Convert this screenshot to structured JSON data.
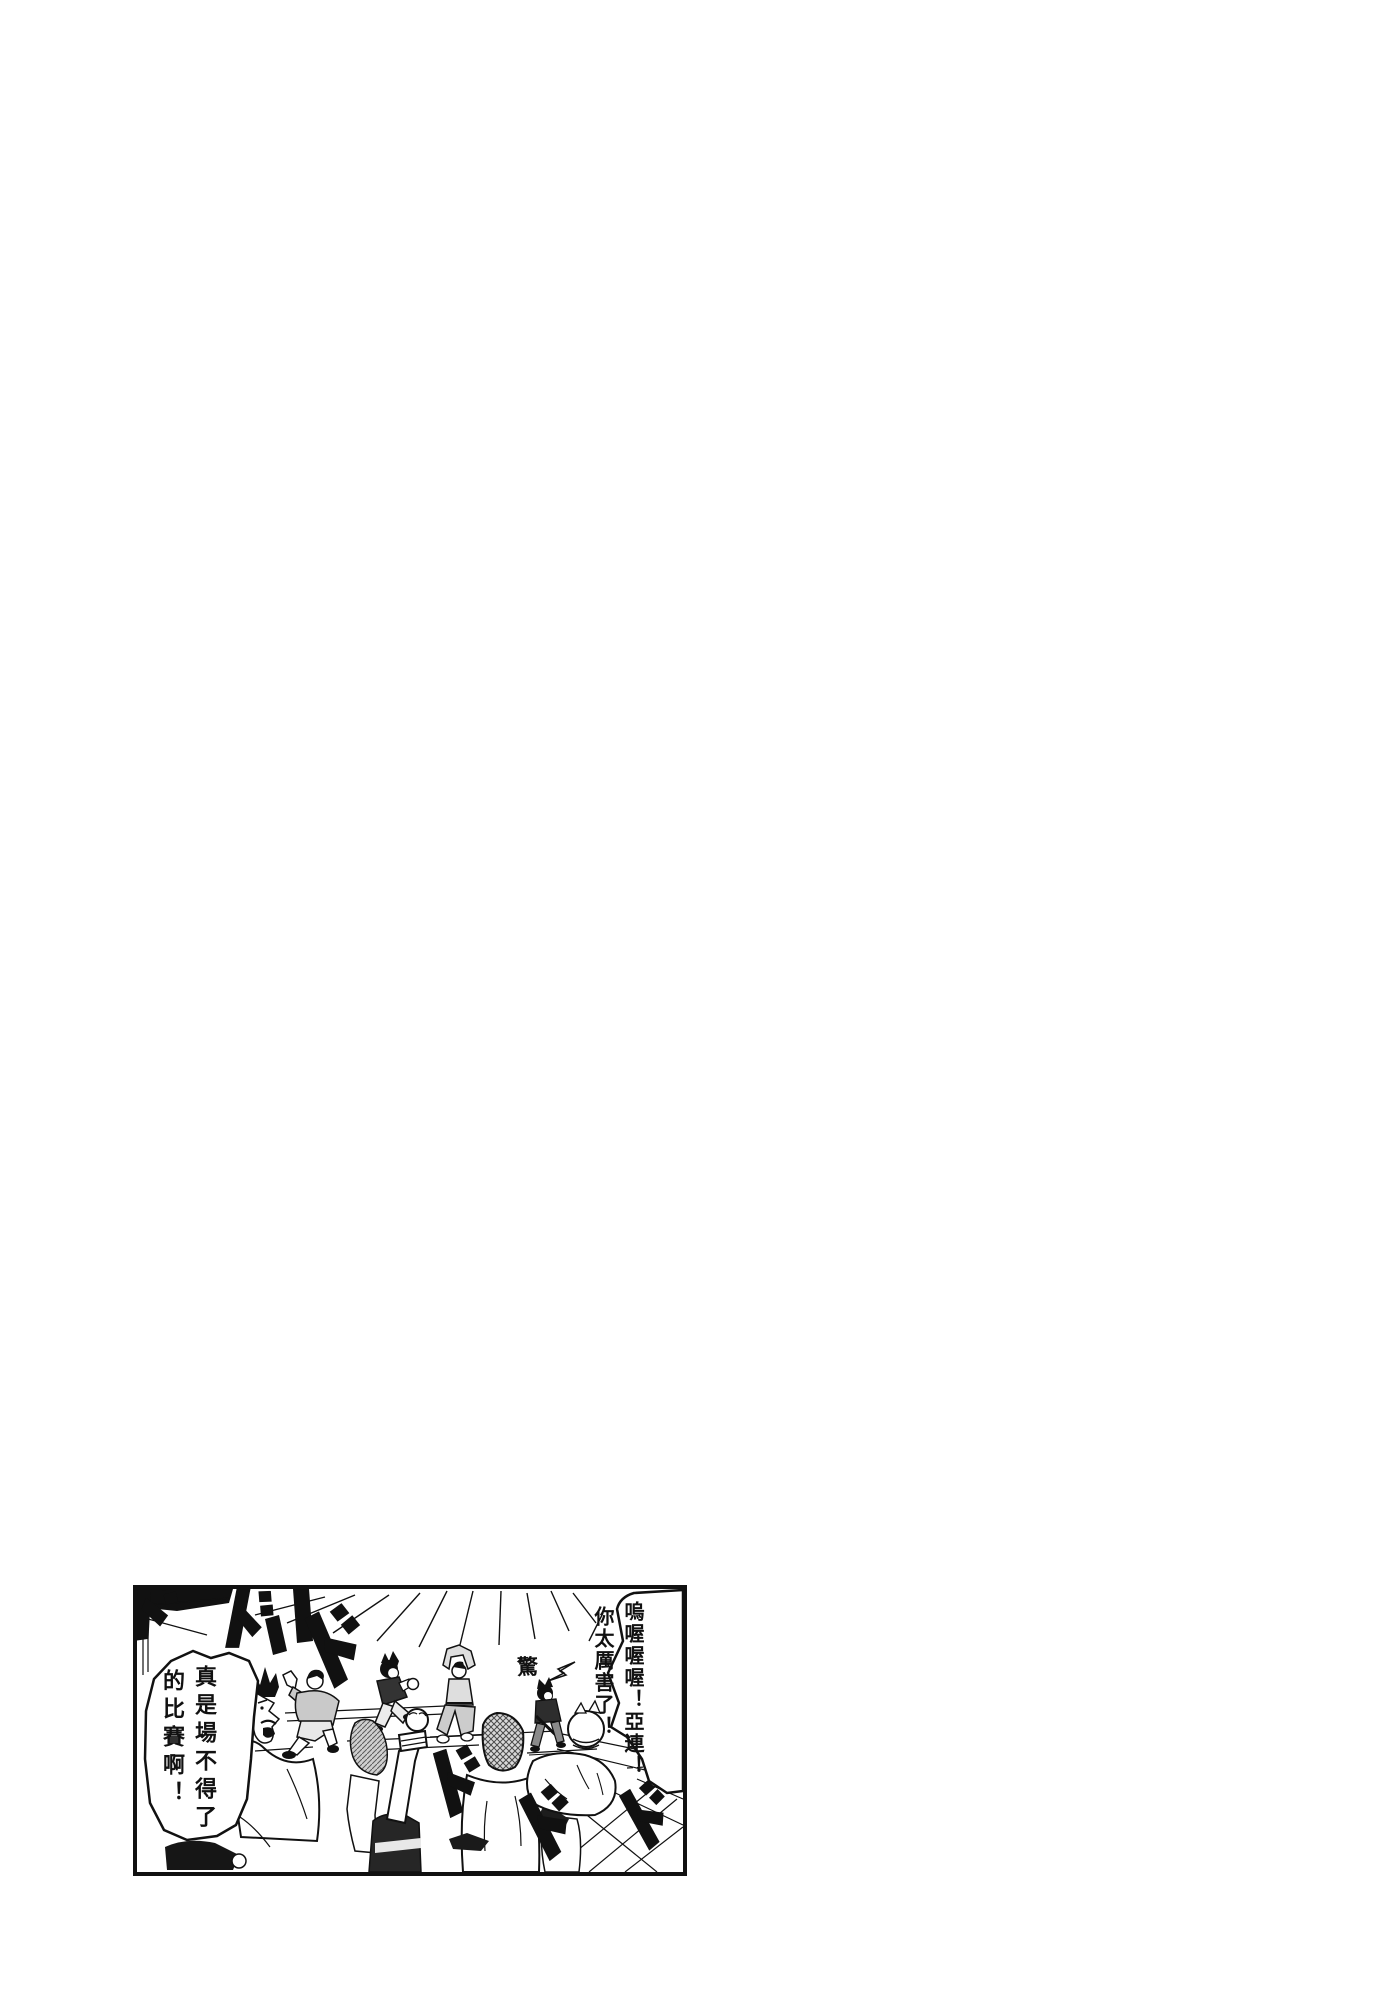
{
  "page": {
    "kind": "manga page"
  },
  "panel": {
    "bubble_right": {
      "columns": [
        "嗚喔喔喔！亞連！",
        "你太厲害了！"
      ],
      "full_text": "嗚喔喔喔！亞連！你太厲害了！"
    },
    "bubble_left": {
      "columns": [
        "真是場不得了",
        "的比賽啊！"
      ],
      "full_text": "真是場不得了的比賽啊！"
    },
    "surprise_kanji": "驚",
    "sfx_mark": "ド",
    "colors": {
      "ink": "#111111",
      "paper": "#ffffff",
      "gray_light": "#d6d6d6",
      "gray_mid": "#c9c9c9"
    }
  }
}
